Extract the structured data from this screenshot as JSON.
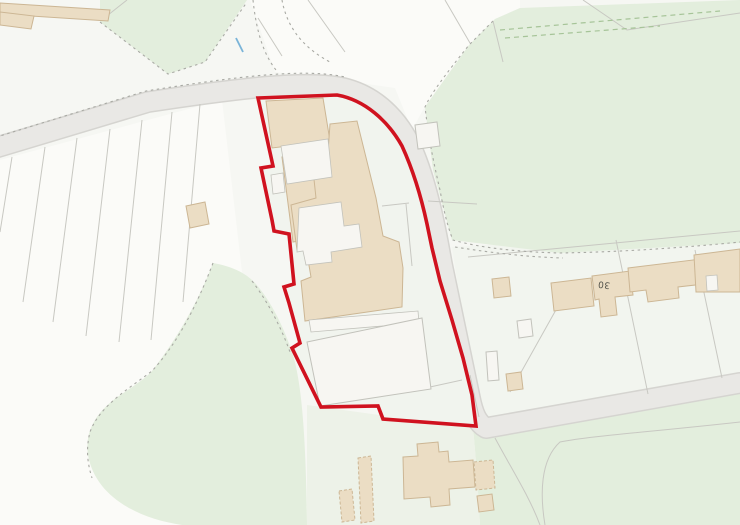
{
  "map": {
    "width": 740,
    "height": 525,
    "colors": {
      "background": "#f6f7f3",
      "plot_white": "#fbfbf8",
      "plot_pale": "#f2f5ef",
      "field_green": "#e3eedd",
      "pale_green": "#edf2e8",
      "site_pale": "#f1f4ee",
      "road_fill": "#e9e8e5",
      "road_casing": "#d5d4d0",
      "line_gray": "#c8c8c2",
      "dotted_gray": "#a9aaa4",
      "building_tan": "#ebddc4",
      "building_tan_border": "#ccb694",
      "building_white": "#f7f6f2",
      "building_white_border": "#c2c2bb",
      "hedge_green": "#a6c498",
      "stream_blue": "#7ab4d8",
      "boundary_red": "#d0121f",
      "label_color": "#4f4f48"
    },
    "label": {
      "text": "30",
      "x": 604,
      "y": 284,
      "rotation": 187
    },
    "shapes": [
      {
        "name": "background",
        "d": "M0 0H740V525H0Z",
        "fill": "background"
      },
      {
        "name": "allotment-plots-area",
        "d": "M0 160 L222 100 L242 272 L312 525 L0 525 Z",
        "fill": "plot_white"
      },
      {
        "name": "junction-plots-area",
        "d": "M250 0 L520 0 L520 8 L495 19 L468 46 L424 108 L412 130 L395 88 L340 80 L275 72 Z",
        "fill": "plot_white"
      },
      {
        "name": "east-plots-area",
        "d": "M452 247 L740 230 L740 376 L483 425 L465 333 Z",
        "fill": "plot_pale"
      },
      {
        "name": "green-top-center",
        "d": "M100 0 L247 0 L205 62 L168 74 L100 22 Z",
        "fill": "field_green"
      },
      {
        "name": "green-field-northeast",
        "d": "M740 0 L520 8 L495 19 L469 45 L425 107 L433 170 L452 240 L560 253 L740 243 Z",
        "fill": "field_green"
      },
      {
        "name": "green-band-and-paddock",
        "d": "M213 263 C230 266 245 272 255 283 C272 302 285 330 293 355 C302 385 306 440 307 525 L182 525 C135 518 95 495 88 455 C84 428 100 408 122 394 C138 383 148 376 152 371 C170 348 195 310 213 263 Z",
        "fill": "field_green"
      },
      {
        "name": "green-field-southeast",
        "d": "M473 428 L740 392 L740 525 L480 525 C478 490 476 458 473 428 Z",
        "fill": "field_green"
      },
      {
        "name": "pale-green-south",
        "d": "M307 405 L473 428 C476 458 478 490 480 525 L307 525 Z",
        "fill": "pale_green"
      },
      {
        "name": "road-casing",
        "d": "M-12 150 L148 102 C240 88 306 80 343 88 C380 97 403 125 415 156 C427 186 435 224 442 264 L470 398 C473 413 477 423 486 428 L740 383",
        "stroke": "road_casing",
        "sw": 22,
        "cap": "round",
        "join": "round"
      },
      {
        "name": "road-surface",
        "d": "M-12 150 L148 102 C240 88 306 80 343 88 C380 97 403 125 415 156 C427 186 435 224 442 264 L470 398 C473 413 477 423 486 428 L740 383",
        "stroke": "road_fill",
        "sw": 19,
        "cap": "round",
        "join": "round"
      },
      {
        "name": "site-interior",
        "d": "M258 98 L337 95 C365 100 388 121 402 146 C413 170 421 196 427 224 L432 248 L440 281 L452 320 L463 358 L472 395 L476 426 L383 419 L378 406 L321 407 L292 348 L300 343 L289 303 L284 287 L294 284 L289 234 L274 231 L272 220 L261 168 L273 166 Z",
        "fill": "site_pale"
      },
      {
        "name": "allotment-strip-dividers",
        "d": "M12 157 L0 232 M45 147 L23 302 M77 138 L53 322 M110 129 L86 336 M142 120 L119 342 M172 112 L151 340 M200 104 L183 302",
        "stroke": "line_gray",
        "sw": 1
      },
      {
        "name": "plot-boundary-lines",
        "d": "M258 18 L282 56 M308 0 L345 52 M445 0 L470 43 M493 21 L503 62 M583 0 L627 30 L740 13 M468 257 L740 231 M616 240 L648 394 M695 250 L722 378 M557 308 L510 392 M470 375 L479 417 M382 206 L409 203 M406 204 L412 266 M430 387 L462 380 M428 201 L477 204 M127 0 L103 19",
        "stroke": "line_gray",
        "sw": 1
      },
      {
        "name": "dotted-boundaries",
        "d": "M-10 139 L146 91 C240 76 305 68 345 77 M253 0 C256 28 262 52 276 70 M282 0 C286 22 298 45 330 62 M493 21 L469 45 C445 75 430 95 425 107 C429 140 433 160 440 190 C444 212 448 228 453 240 C480 248 520 252 560 253 C620 252 680 248 740 242 M455 247 C500 254 530 257 563 258 M213 263 C196 308 176 345 152 371 C130 388 100 405 90 432 C86 448 87 462 92 478 M252 281 C268 302 281 327 290 352 M100 22 L168 74 L205 62 L247 2",
        "stroke": "dotted_gray",
        "sw": 1.1,
        "dash": "2.5 3.5"
      },
      {
        "name": "hedge-dashes",
        "d": "M500 30 L720 11 M505 38 L660 26",
        "stroke": "hedge_green",
        "sw": 1.2,
        "dash": "5 4"
      },
      {
        "name": "field-paths-southeast",
        "d": "M740 422 C650 432 590 436 560 442 C540 460 540 495 545 525 M495 438 C515 475 530 498 540 525",
        "stroke": "line_gray",
        "sw": 1
      },
      {
        "name": "stream",
        "d": "M236 38 L243 52",
        "stroke": "stream_blue",
        "sw": 1.8
      },
      {
        "name": "building-topleft-strip",
        "d": "M0 3 L110 10 L108 21 L0 14 Z",
        "fill": "building_tan",
        "stroke": "building_tan_border",
        "sw": 1
      },
      {
        "name": "building-topleft-block",
        "d": "M0 12 L34 16 L31 29 L0 25 Z",
        "fill": "building_tan",
        "stroke": "building_tan_border",
        "sw": 1
      },
      {
        "name": "building-west-small",
        "d": "M186 206 L205 202 L209 224 L190 228 Z",
        "fill": "building_tan",
        "stroke": "building_tan_border",
        "sw": 1
      },
      {
        "name": "site-building-north",
        "d": "M266 101 L323 98 L330 141 L272 148 Z",
        "fill": "building_tan",
        "stroke": "building_tan_border",
        "sw": 1
      },
      {
        "name": "site-building-west-wing",
        "d": "M282 157 L313 152 L324 236 L293 242 Z",
        "fill": "building_tan",
        "stroke": "building_tan_border",
        "sw": 1
      },
      {
        "name": "site-building-main",
        "d": "M330 124 L357 121 L376 198 L383 236 L399 242 L403 268 L402 307 L305 321 L301 281 L311 277 L306 248 L297 250 L291 205 L316 198 L313 170 L327 167 Z",
        "fill": "building_tan",
        "stroke": "building_tan_border",
        "sw": 1
      },
      {
        "name": "site-courtyard-upper",
        "d": "M281 146 L328 139 L332 177 L287 184 Z",
        "fill": "building_white",
        "stroke": "building_white_border",
        "sw": 0.8
      },
      {
        "name": "site-courtyard-center",
        "d": "M299 208 L341 202 L344 226 L359 224 L362 247 L331 252 L332 262 L306 265 L303 251 L297 252 Z",
        "fill": "building_white",
        "stroke": "building_white_border",
        "sw": 0.8
      },
      {
        "name": "site-courtyard-notch",
        "d": "M271 175 L283 173 L285 192 L273 194 Z",
        "fill": "building_white",
        "stroke": "building_white_border",
        "sw": 0.8
      },
      {
        "name": "site-terrace-strip",
        "d": "M309 320 L418 311 L419 323 L311 332 Z",
        "fill": "building_white",
        "stroke": "building_white_border",
        "sw": 0.8
      },
      {
        "name": "site-outbuilding-south",
        "d": "M307 342 L422 318 L431 389 L320 406 Z",
        "fill": "building_white",
        "stroke": "building_white_border",
        "sw": 1
      },
      {
        "name": "shed-white-north",
        "d": "M415 125 L437 122 L440 146 L418 149 Z",
        "fill": "building_white",
        "stroke": "building_white_border",
        "sw": 1
      },
      {
        "name": "shed-tan-east-1",
        "d": "M492 279 L509 277 L511 296 L494 298 Z",
        "fill": "building_tan",
        "stroke": "building_tan_border",
        "sw": 1
      },
      {
        "name": "shed-white-east",
        "d": "M517 321 L531 319 L533 336 L519 338 Z",
        "fill": "building_white",
        "stroke": "building_white_border",
        "sw": 1
      },
      {
        "name": "greenhouse-east",
        "d": "M486 352 L497 351 L499 380 L488 381 Z",
        "fill": "building_white",
        "stroke": "building_white_border",
        "sw": 1
      },
      {
        "name": "shed-tan-east-2",
        "d": "M506 374 L521 372 L523 389 L508 391 Z",
        "fill": "building_tan",
        "stroke": "building_tan_border",
        "sw": 1
      },
      {
        "name": "terrace-house-1",
        "d": "M551 283 L591 278 L594 306 L554 311 Z",
        "fill": "building_tan",
        "stroke": "building_tan_border",
        "sw": 1
      },
      {
        "name": "terrace-house-30",
        "d": "M592 276 L630 271 L633 295 L615 297 L617 315 L601 317 L599 299 L595 300 Z",
        "fill": "building_tan",
        "stroke": "building_tan_border",
        "sw": 1
      },
      {
        "name": "terrace-house-2",
        "d": "M628 268 L701 259 L704 284 L678 287 L679 298 L648 302 L646 290 L630 292 Z",
        "fill": "building_tan",
        "stroke": "building_tan_border",
        "sw": 1
      },
      {
        "name": "terrace-house-3",
        "d": "M694 255 L740 249 L740 292 L696 292 Z",
        "fill": "building_tan",
        "stroke": "building_tan_border",
        "sw": 1
      },
      {
        "name": "terrace-house-3-notch",
        "d": "M706 276 L717 275 L718 290 L707 291 Z",
        "fill": "building_white",
        "stroke": "building_white_border",
        "sw": 0.8
      },
      {
        "name": "house-south-main",
        "d": "M403 457 L418 456 L417 444 L438 442 L439 452 L448 451 L449 462 L473 460 L475 487 L449 489 L450 505 L431 507 L430 497 L404 499 Z",
        "fill": "building_tan",
        "stroke": "building_tan_border",
        "sw": 1
      },
      {
        "name": "house-south-ext",
        "d": "M474 462 L493 460 L495 488 L476 490 Z",
        "fill": "building_tan",
        "stroke": "building_tan_border",
        "sw": 1,
        "dash": "3 2"
      },
      {
        "name": "house-south-small",
        "d": "M477 496 L492 494 L494 510 L479 512 Z",
        "fill": "building_tan",
        "stroke": "building_tan_border",
        "sw": 1
      },
      {
        "name": "glasshouse-strip-1",
        "d": "M339 491 L352 489 L355 520 L342 522 Z",
        "fill": "building_tan",
        "stroke": "building_tan_border",
        "sw": 1,
        "dash": "3 2"
      },
      {
        "name": "glasshouse-strip-2",
        "d": "M358 458 L371 456 L374 521 L361 523 Z",
        "fill": "building_tan",
        "stroke": "building_tan_border",
        "sw": 1,
        "dash": "3 2"
      },
      {
        "name": "site-boundary",
        "d": "M258 98 L337 95 C365 100 388 121 402 146 C413 170 421 196 427 224 L432 248 L440 281 L452 320 L463 358 L472 395 L476 426 L383 419 L378 406 L321 407 L292 348 L300 343 L289 303 L284 287 L294 284 L289 234 L274 231 L272 220 L261 168 L273 166 Z",
        "stroke": "boundary_red",
        "sw": 3.6,
        "join": "miter"
      }
    ]
  }
}
